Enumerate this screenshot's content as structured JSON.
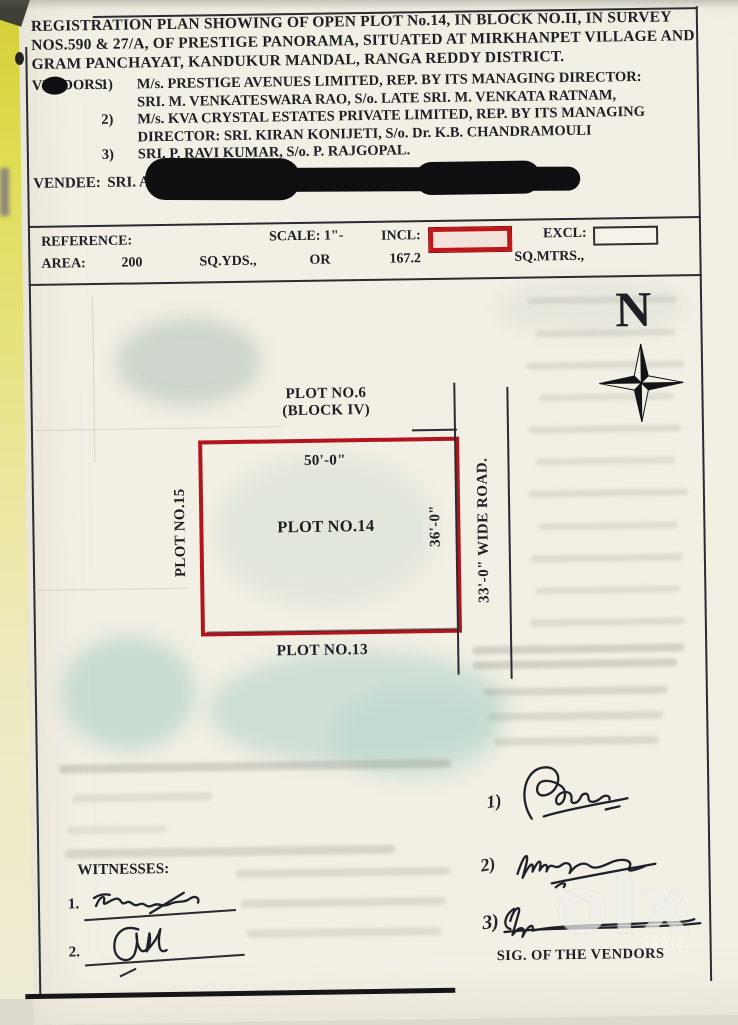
{
  "header": {
    "title": "REGISTRATION PLAN SHOWING OF OPEN PLOT No.14, IN BLOCK NO.II, IN SURVEY NOS.590 & 27/A, OF PRESTIGE PANORAMA, SITUATED AT MIRKHANPET VILLAGE AND GRAM PANCHAYAT, KANDUKUR MANDAL, RANGA REDDY DISTRICT.",
    "vendors_label": "VENDORS:",
    "vendors": [
      {
        "num": "1)",
        "line1": "M/s. PRESTIGE AVENUES LIMITED, REP. BY ITS MANAGING DIRECTOR:",
        "line2": "SRI. M. VENKATESWARA RAO, S/o. LATE SRI. M. VENKATA RATNAM,"
      },
      {
        "num": "2)",
        "line1": "M/s. KVA CRYSTAL ESTATES PRIVATE LIMITED, REP. BY ITS MANAGING",
        "line2": "DIRECTOR: SRI. KIRAN KONIJETI, S/o. Dr. K.B. CHANDRAMOULI"
      },
      {
        "num": "3)",
        "line1": "SRI. P. RAVI KUMAR, S/o. P. RAJGOPAL.",
        "line2": ""
      }
    ],
    "vendee_label": "VENDEE:",
    "vendee_text": "SRI. A"
  },
  "reference": {
    "label": "REFERENCE:",
    "scale_label": "SCALE: 1\"-",
    "incl_label": "INCL:",
    "excl_label": "EXCL:",
    "area_label": "AREA:",
    "area_sqyds": "200",
    "sqyds_label": "SQ.YDS.,",
    "or_label": "OR",
    "area_sqmtrs": "167.2",
    "sqmtrs_label": "SQ.MTRS.,"
  },
  "plan": {
    "north_label": "N",
    "plot_top_line1": "PLOT NO.6",
    "plot_top_line2": "(BLOCK IV)",
    "plot_main": "PLOT NO.14",
    "plot_left": "PLOT NO.15",
    "plot_bottom": "PLOT NO.13",
    "road_label": "33'-0\" WIDE ROAD.",
    "dim_top": "50'-0\"",
    "dim_right": "36'-0\"",
    "colors": {
      "plot_border_red": "#b2161c",
      "incl_swatch_red": "#bf161a"
    }
  },
  "signatures": {
    "items": [
      {
        "num": "1)"
      },
      {
        "num": "2)"
      },
      {
        "num": "3)"
      }
    ],
    "caption": "SIG. OF THE VENDORS"
  },
  "witnesses": {
    "label": "WITNESSES:",
    "items": [
      {
        "num": "1."
      },
      {
        "num": "2."
      }
    ]
  },
  "watermark": {
    "text": "olx",
    "sub": "INDIA"
  }
}
